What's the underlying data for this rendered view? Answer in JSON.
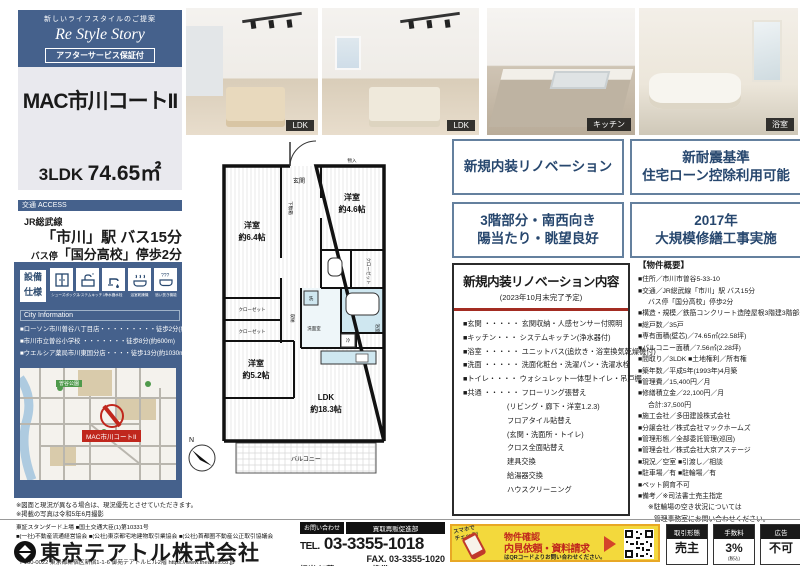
{
  "brand": {
    "tagline": "新しいライフスタイルのご提案",
    "logo": "Re Style Story",
    "badge": "アフターサービス保証付"
  },
  "property": {
    "name": "MAC市川コートII",
    "layout": "3LDK",
    "area": "74.65㎡"
  },
  "access": {
    "header": "交通 ACCESS",
    "rail": "JR総武線",
    "station": "「市川」駅 バス15分",
    "bus_prefix": "バス停",
    "bus": "「国分高校」停歩2分"
  },
  "equipment": {
    "label_1": "設備",
    "label_2": "仕様",
    "items": [
      "シューズボックス",
      "システムキッチン",
      "浄水器水栓",
      "浴室乾燥機",
      "追い焚き機能"
    ]
  },
  "city_info": {
    "header": "City Information",
    "items": [
      "■ローソン市川曽谷八丁目店・・・・・・・・・徒歩2分(約150m)",
      "■市川市立曽谷小学校 ・・・・・・・徒歩8分(約600m)",
      "■ウエルシア薬局市川東国分店・・・・徒歩13分(約1030m)"
    ]
  },
  "map": {
    "marker_label": "MAC市川コートII",
    "park_label": "曽谷公園"
  },
  "notes": {
    "line1": "※図面と現況が異なる場合は、現況優先とさせていただきます。",
    "line2": "※掲載の写真は令和5年6月撮影"
  },
  "photos": [
    {
      "badge": "LDK"
    },
    {
      "badge": "LDK"
    },
    {
      "badge": "キッチン"
    },
    {
      "badge": "浴室"
    }
  ],
  "feature_badges": [
    {
      "line1": "新規内装リノベーション",
      "line2": ""
    },
    {
      "line1": "新耐震基準",
      "line2": "住宅ローン控除利用可能"
    },
    {
      "line1": "3階部分・南西向き",
      "line2": "陽当たり・眺望良好"
    },
    {
      "line1": "2017年",
      "line2": "大規模修繕工事実施"
    }
  ],
  "renovation": {
    "title": "新規内装リノベーション内容",
    "subtitle": "(2023年10月末完了予定)",
    "items": [
      "■玄関 ・・・・・ 玄関収納・人感センサー付照明",
      "■キッチン・・・ システムキッチン(浄水器付)",
      "■浴室 ・・・・・ ユニットバス(追炊き・浴室換気乾燥機付)",
      "■洗面 ・・・・・ 洗面化粧台・洗濯パン・洗濯水栓",
      "■トイレ・・・・ ウォシュレット一体型トイレ・吊戸棚",
      "■共通 ・・・・・ フローリング張替え",
      "(リビング・廊下・洋室1.2.3)",
      "フロアタイル貼替え",
      "(玄関・洗面所・トイレ)",
      "クロス全面貼替え",
      "建具交換",
      "給湯器交換",
      "ハウスクリーニング"
    ]
  },
  "overview": {
    "heading": "【物件概要】",
    "items": [
      "■住所／市川市曽谷5-33-10",
      "■交通／JR総武線「市川」駅 バス15分",
      "バス停「国分高校」停歩2分",
      "■構造・規模／鉄筋コンクリート造陸屋根3階建3階部分",
      "■総戸数／35戸",
      "■専有面積(壁芯)／74.65㎡(22.58坪)",
      "■バルコニー面積／7.56㎡(2.28坪)",
      "■間取り／3LDK ■土地権利／所有権",
      "■築年数／平成5年(1993年)4月築",
      "■管理費／15,400円／月",
      "■修繕積立金／22,100円／月",
      "合計:37,500円",
      "■施工会社／多田建設株式会社",
      "■分譲会社／株式会社マックホームズ",
      "■管理形態／全部委託管理(巡回)",
      "■管理会社／株式会社大京アステージ",
      "■現況／空室 ■引渡し／相談",
      "■駐車場／有 ■駐輪場／有",
      "■ペット飼育不可",
      "■備考／※司法書士売主指定",
      "※駐輪場の空き状況については",
      "管理事務室にお問い合わせください。"
    ]
  },
  "plan": {
    "genkan": "玄関",
    "getabako": "下駄箱",
    "monoire": "物入",
    "room1": "洋室",
    "room1_size": "約6.4帖",
    "room2": "洋室",
    "room2_size": "約4.6帖",
    "room3": "洋室",
    "room3_size": "約5.2帖",
    "closet_r": "クローゼット",
    "closet_l1": "クローゼット",
    "closet_l2": "クローゼット",
    "storage": "収納",
    "wash": "洗",
    "senmen": "洗面室",
    "bath": "浴室",
    "fridge": "冷",
    "ldk": "LDK",
    "ldk_size": "約18.3帖",
    "balcony": "バルコニー"
  },
  "footer": {
    "license1": "東証スタンダード上場 ■国土交通大臣(1)第10331号",
    "license2": "■(一社)不動産流通経営協会 ■(公社)東京都宅地建物取引業協会 ■(公社)首都圏不動産公正取引協議会",
    "company": "東京テアトル株式会社",
    "address": "〒160-0022 東京都新宿区新宿1-1-6 御苑テアトルビル2階",
    "url": "https://www.theatres.co.jp",
    "contact_label": "お問い合わせ",
    "dept": "買取再販促進部",
    "tel_prefix": "TEL.",
    "tel": "03-3355-1018",
    "fax": "FAX. 03-3355-1020",
    "person": "担当/加藤",
    "mobile": "携帯 080-9807-2137"
  },
  "promo": {
    "check1": "スマホで",
    "check2": "チェック!",
    "title1": "物件確認",
    "title2": "内見依頼・資料請求",
    "note": "はQRコードよりお問い合わせください。"
  },
  "deal_badges": [
    {
      "head": "取引形態",
      "value": "売主",
      "sub": ""
    },
    {
      "head": "手数料",
      "value": "3%",
      "sub": "(税込)"
    },
    {
      "head": "広告",
      "value": "不可",
      "sub": ""
    }
  ],
  "colors": {
    "navy": "#45618c",
    "badge_border": "#64809e",
    "badge_text": "#27476e",
    "accent_red": "#c0271d",
    "promo_yellow": "#f3d93c"
  }
}
